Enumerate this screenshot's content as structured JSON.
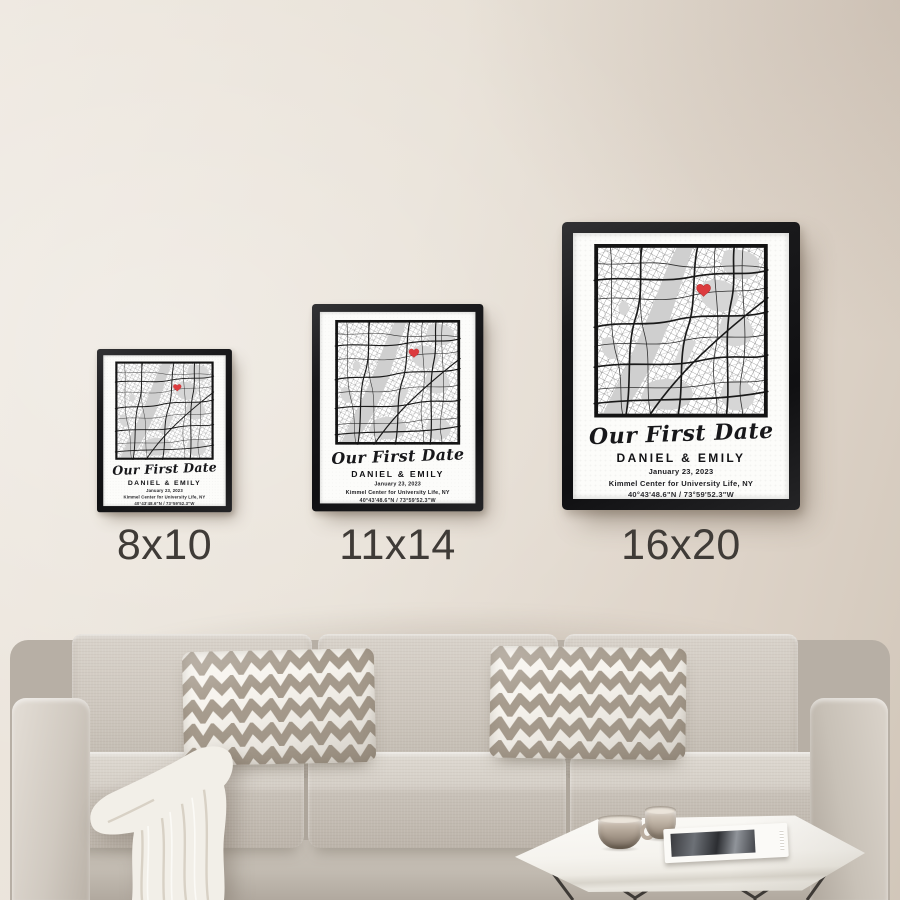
{
  "prints": {
    "title": "Our First Date",
    "names": "DANIEL & EMILY",
    "date": "January 23, 2023",
    "location": "Kimmel Center for University Life, NY",
    "coordinates": "40°43'48.6\"N / 73°59'52.3\"W",
    "marker_icon": "heart",
    "marker_color": "#dc3b3e"
  },
  "size_options": [
    {
      "label": "8x10"
    },
    {
      "label": "11x14"
    },
    {
      "label": "16x20"
    }
  ],
  "palette": {
    "wall": "#e7e0d6",
    "frame": "#19191b",
    "paper": "#fcfcfa",
    "map_roads": "#222222",
    "map_water": "#cfcfcf",
    "heart_red": "#dc3b3e",
    "sofa": "#cfc8bf",
    "chevron_taupe": "#a79c8e",
    "blanket": "#f2efe8",
    "table": "#f7f5f0"
  }
}
